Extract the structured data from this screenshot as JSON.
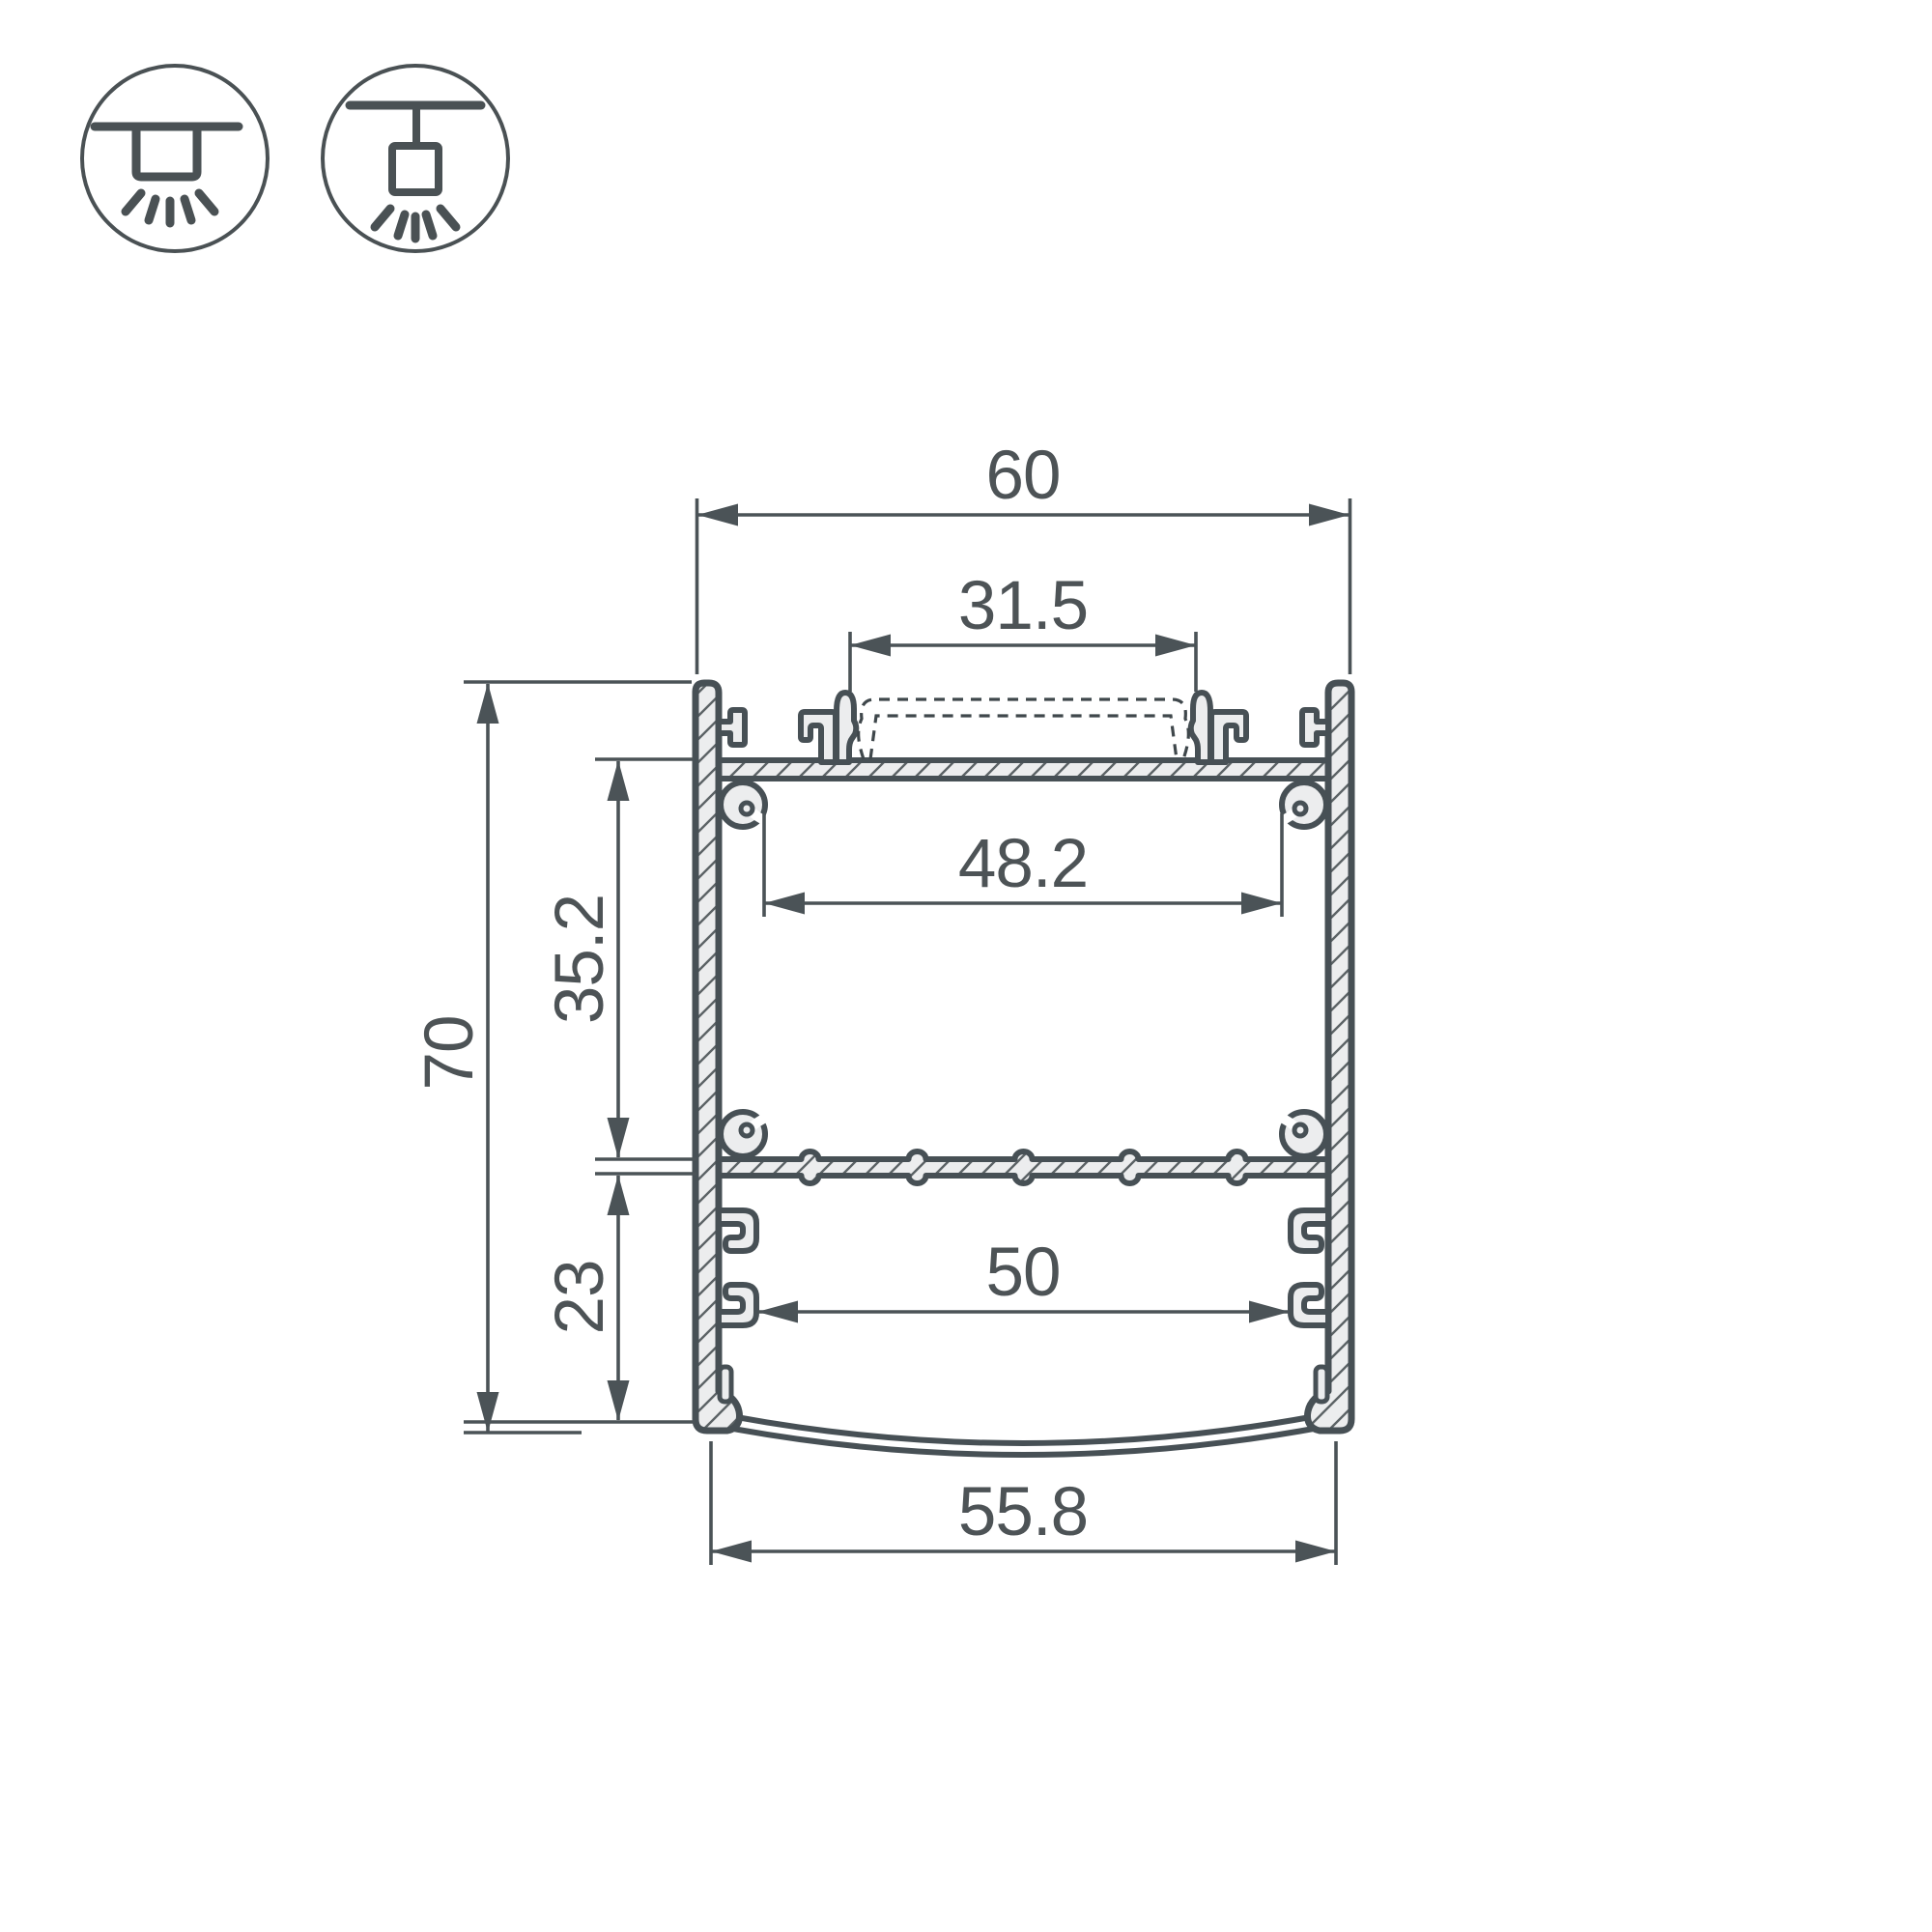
{
  "drawing": {
    "type": "led-profile-cross-section",
    "colors": {
      "line": "#475055",
      "fill": "#ecedee",
      "text": "#4d5356",
      "background": "#ffffff"
    },
    "dimensions": {
      "outer_width": "60",
      "led_slot_width": "31.5",
      "chamber_inner_width": "48.2",
      "overall_height": "70",
      "upper_chamber_height": "35.2",
      "lower_chamber_height": "23",
      "lower_chamber_width": "50",
      "diffuser_width": "55.8"
    },
    "icons": {
      "surface_mount": "surface-ceiling-mount-icon",
      "pendant_mount": "suspended-ceiling-mount-icon"
    }
  }
}
